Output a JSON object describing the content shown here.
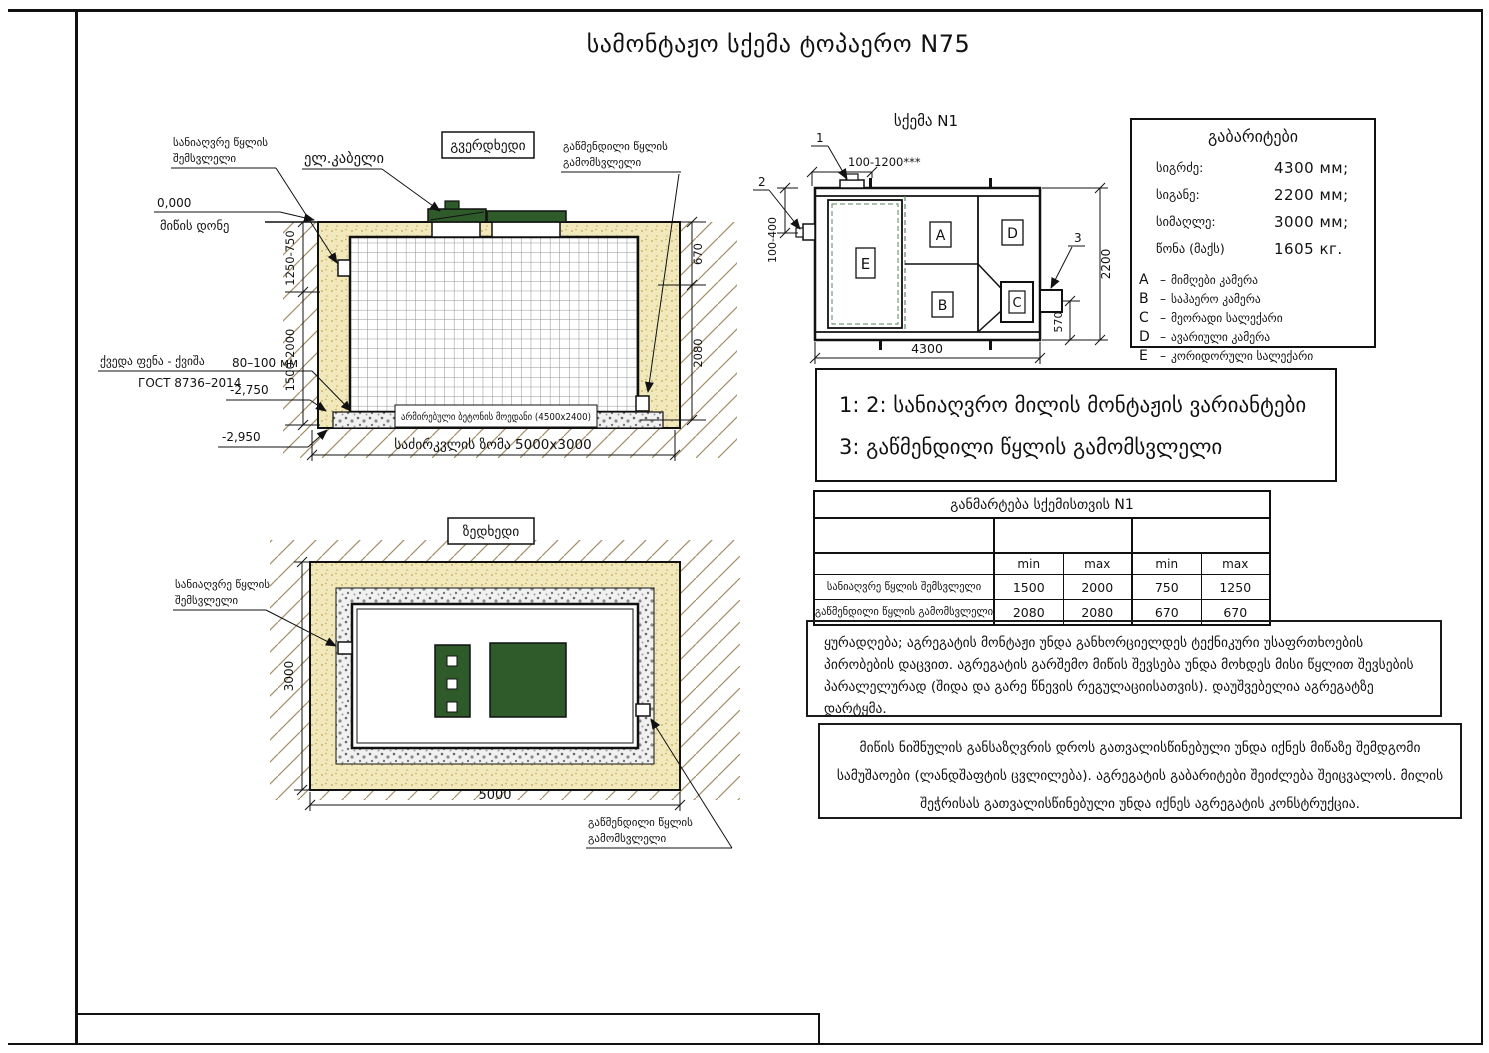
{
  "page": {
    "title": "სამონტაჟო სქემა ტოპაერო N75"
  },
  "side_view": {
    "view_label": "გვერდხედი",
    "inlet_label_l1": "სანიაღვრე წყლის",
    "inlet_label_l2": "შემსვლელი",
    "cable_label": "ელ.კაბელი",
    "outlet_label_l1": "გაწმენდილი წყლის",
    "outlet_label_l2": "გამომსვლელი",
    "zero_mark": "0,000",
    "ground_label": "მიწის დონე",
    "bottom_layer_label": "ქვედა ფენა - ქვიშა",
    "bottom_layer_size": "80–100 мм",
    "gost_label": "ГОСТ 8736–2014",
    "level_2750": "-2,750",
    "level_2950": "-2,950",
    "pad_label": "არმირებული ბეტონის მოედანი (4500x2400)",
    "foundation_label": "საძირკვლის ზომა 5000x3000",
    "dim_left_upper": "1250-750",
    "dim_left_lower": "1500-2000",
    "dim_right_upper": "670",
    "dim_right_lower": "2080"
  },
  "scheme": {
    "title": "სქემა N1",
    "callout_1": "1",
    "callout_2": "2",
    "callout_3": "3",
    "dim_top": "100-1200***",
    "dim_left": "100-400",
    "dim_height": "2200",
    "dim_outlet": "570",
    "dim_width": "4300",
    "comp_a": "A",
    "comp_b": "B",
    "comp_c": "C",
    "comp_d": "D",
    "comp_e": "E"
  },
  "parameters": {
    "title": "გაბარიტები",
    "rows": [
      {
        "label": "სიგრძე:",
        "value": "4300 мм;"
      },
      {
        "label": "სიგანე:",
        "value": "2200 мм;"
      },
      {
        "label": "სიმაღლე:",
        "value": "3000 мм;"
      },
      {
        "label": "წონა (მაქს)",
        "value": "1605 кг."
      }
    ],
    "dash": "–",
    "legend": [
      {
        "key": "A",
        "desc": "მიმღები კამერა"
      },
      {
        "key": "B",
        "desc": "საჰაერო კამერა"
      },
      {
        "key": "C",
        "desc": "მეორადი სალექარი"
      },
      {
        "key": "D",
        "desc": "ავარიული კამერა"
      },
      {
        "key": "E",
        "desc": "კორიდორული სალექარი"
      }
    ]
  },
  "variants": {
    "line1": "1: 2: სანიაღვრო მილის მონტაჟის ვარიანტები",
    "line2": "3: გაწმენდილი წყლის გამომსვლელი"
  },
  "spec_table": {
    "title": "განმარტება სქემისთვის N1",
    "columns": [
      "min",
      "max",
      "min",
      "max"
    ],
    "rows": [
      {
        "label": "სანიაღვრე წყლის შემსვლელი",
        "values": [
          "1500",
          "2000",
          "750",
          "1250"
        ]
      },
      {
        "label": "გაწმენდილი წყლის გამომსვლელი",
        "values": [
          "2080",
          "2080",
          "670",
          "670"
        ]
      }
    ]
  },
  "notes": {
    "note1": "ყურადღება; აგრეგატის მონტაჟი უნდა განხორციელდეს ტექნიკური უსაფრთხოების პირობების დაცვით. აგრეგატის გარშემო მიწის შევსება უნდა მოხდეს მისი წყლით შევსების პარალელურად (შიდა და გარე წნევის რეგულაციისათვის). დაუშვებელია აგრეგატზე დარტყმა.",
    "note2": "მიწის ნიშნულის განსაზღვრის დროს გათვალისწინებული უნდა იქნეს მიწაზე შემდგომი სამუშაოები (ლანდშაფტის ცვლილება). აგრეგატის გაბარიტები შეიძლება შეიცვალოს. მილის შეჭრისას გათვალისწინებული უნდა იქნეს აგრეგატის  კონსტრუქცია."
  },
  "top_view": {
    "view_label": "ზედხედი",
    "inlet_label_l1": "სანიაღვრე წყლის",
    "inlet_label_l2": "შემსვლელი",
    "outlet_label_l1": "გაწმენდილი წყლის",
    "outlet_label_l2": "გამომსვლელი",
    "dim_height": "3000",
    "dim_width": "5000"
  },
  "colors": {
    "lid_green": "#2f5b2a",
    "sand": "#f1e9bc",
    "hatch_line": "#a28e66",
    "dash_green": "#57855a"
  }
}
